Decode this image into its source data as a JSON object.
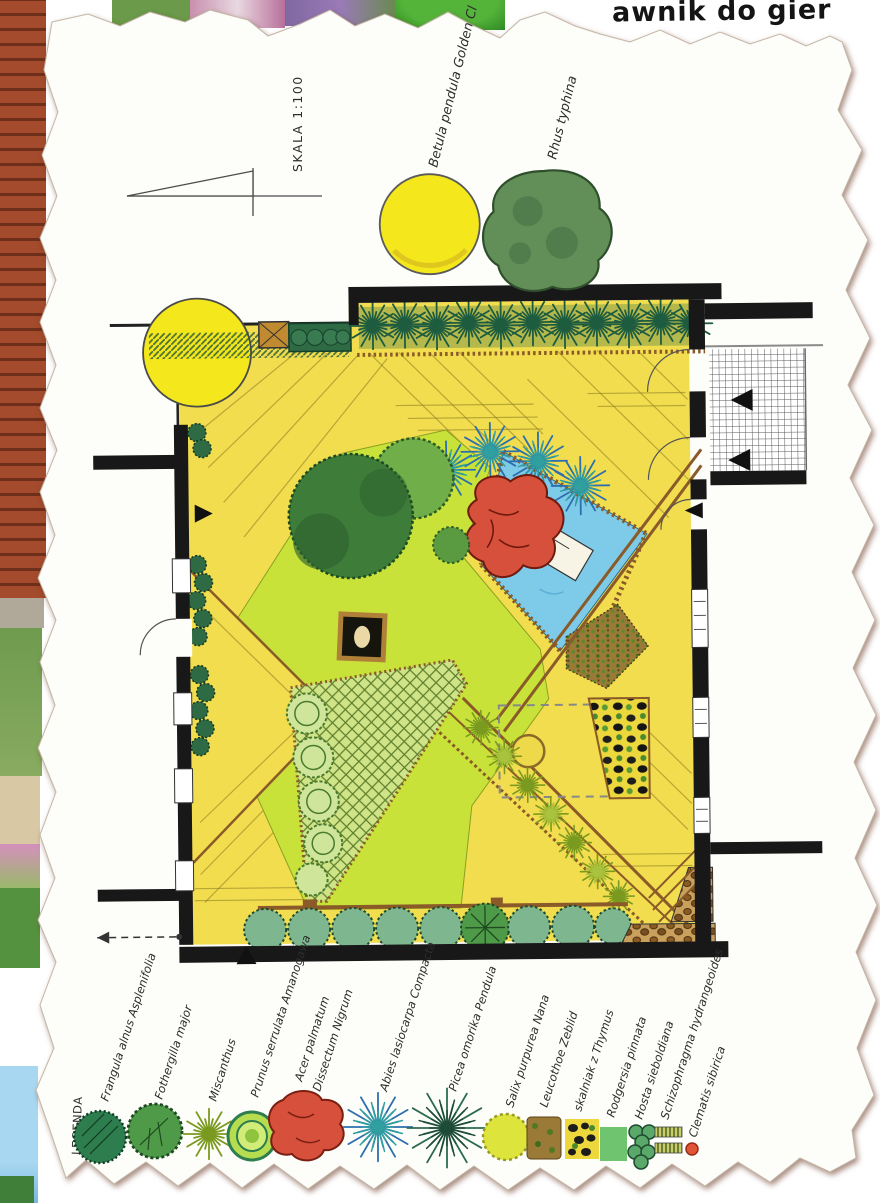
{
  "background": {
    "partial_text": "awnik do gier"
  },
  "plan": {
    "scale_label": "SKALA 1:100",
    "outside_trees": [
      {
        "label": "Betula pendula Golden Cl",
        "symbol": "yellow-circle-tree",
        "color": "#f4e71c"
      },
      {
        "label": "Rhus typhina",
        "symbol": "green-blob-tree",
        "color": "#628f58"
      }
    ],
    "surface_colors": {
      "deck": "#f1dd4e",
      "lawn": "#c8e23a",
      "pond": "#7ecbe9",
      "wall": "#181818",
      "timber_edge": "#8a5a28"
    }
  },
  "legend": {
    "title": "LEGENDA",
    "items": [
      {
        "name": "Frangula alnus Asplenifolia",
        "symbol": "dark-green-hatched-circle",
        "color": "#2e7d4f"
      },
      {
        "name": "Fothergilla major",
        "symbol": "scalloped-green-circle",
        "color": "#4f9a48"
      },
      {
        "name": "Miscanthus",
        "symbol": "grass-starburst",
        "color": "#9cb52f"
      },
      {
        "name": "Prunus serrulata Amanogawa",
        "symbol": "ringed-green-circle",
        "color": "#9fd23f"
      },
      {
        "name": "Acer palmatum",
        "name_line2": "Dissectum Nigrum",
        "symbol": "red-lobed-blob",
        "color": "#d6503b"
      },
      {
        "name": "Abies lasiocarpa Compacta",
        "symbol": "blue-conifer-star",
        "color": "#3d85c0"
      },
      {
        "name": "Picea omorika Pendula",
        "symbol": "dark-conifer-star",
        "color": "#2c6b4f"
      },
      {
        "name": "Salix purpurea Nana",
        "symbol": "yellow-green-scalloped-circle",
        "color": "#dde43c"
      },
      {
        "name": "Leucothoe Zeblid",
        "symbol": "brown-speckled-patch",
        "color": "#9a7a36"
      },
      {
        "name": "skalniak z Thymus",
        "symbol": "rockery-stones-patch",
        "color": "#ecd83c"
      },
      {
        "name": "Rodgersia pinnata",
        "symbol": "green-square-patch",
        "color": "#6fc46f"
      },
      {
        "name": "Hosta sieboldiana",
        "symbol": "green-circle-cluster",
        "color": "#5aa86a"
      },
      {
        "name": "Schizophragma hydrangeoides",
        "symbol": "hatched-strips",
        "color": "#8a8f3a"
      },
      {
        "name": "Clematis sibirica",
        "symbol": "red-dot",
        "color": "#e05535"
      }
    ]
  }
}
